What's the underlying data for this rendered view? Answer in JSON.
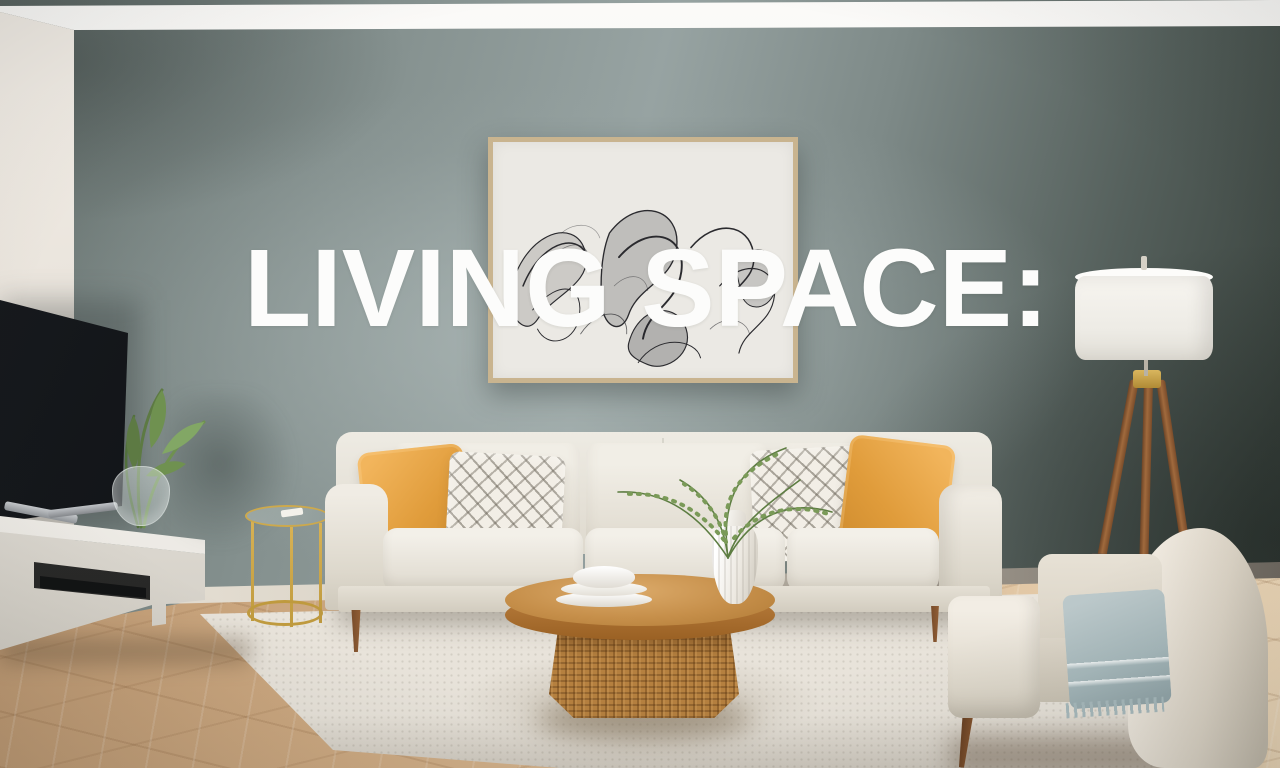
{
  "overlay": {
    "title": "LIVING SPACE:"
  },
  "colors": {
    "accent_wall": "#8a9695",
    "left_wall": "#e9e4dd",
    "ceiling": "#f6f4f1",
    "floor_wood": "#d4b38d",
    "rug": "#e8e3da",
    "sofa_fabric": "#e9e4da",
    "pillow_mustard": "#e09c3b",
    "coffee_table_wood": "#c68f4a",
    "rattan_base": "#b5803f",
    "gold_table": "#bf9a3e",
    "lamp_shade": "#f7f5f0",
    "throw_blanket": "#a8babd",
    "artwork_frame": "#c9b48f",
    "tv_screen": "#101215",
    "plant_green": "#6f9150",
    "text_overlay": "#fcfcfb"
  }
}
